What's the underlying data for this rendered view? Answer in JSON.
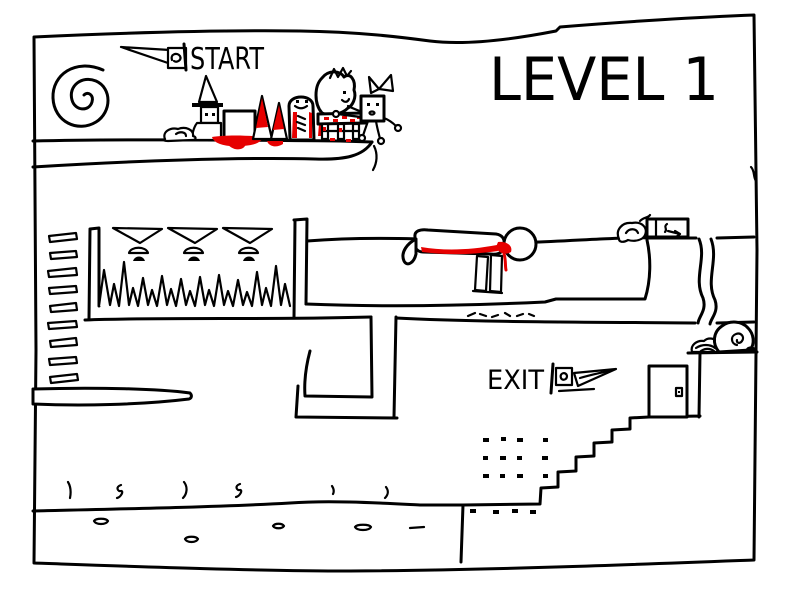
{
  "canvas": {
    "width": 800,
    "height": 600
  },
  "colors": {
    "background": "#ffffff",
    "ink": "#000000",
    "blood": "#e60000"
  },
  "labels": {
    "level_title": "LEVEL 1",
    "start": "START",
    "exit": "EXIT"
  },
  "entities": [
    "level-border",
    "spiral-doodle",
    "start-flag",
    "wizard",
    "small-snail",
    "white-box",
    "bloody-cone",
    "bloody-ghost",
    "princess-on-bloody-bench",
    "ragdoll",
    "ladder-rungs",
    "dripper-funnels",
    "spike-pit",
    "dead-stickman",
    "floor-ticks",
    "bird-scribble",
    "marked-crate",
    "waterfall-lines",
    "maze-walls",
    "left-bar-platform",
    "exit-flag",
    "staircase",
    "door",
    "rock-scribble",
    "big-snail",
    "dots-grid",
    "ground-squiggles",
    "pebbles"
  ]
}
